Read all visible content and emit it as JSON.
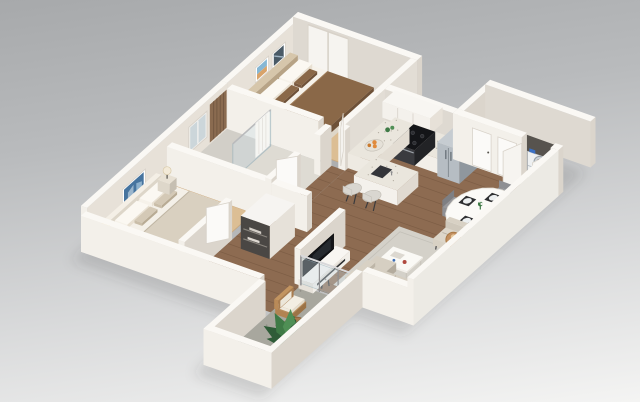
{
  "image": {
    "type": "3d-isometric-floor-plan-render",
    "subject": "Two-bedroom two-bath apartment 3D floor plan",
    "background": {
      "top": "#a7a9ab",
      "bottom": "#f4f4f3"
    }
  },
  "palette": {
    "wallLight": "#f3f0ea",
    "wallShade": "#dbd5cc",
    "wallTop": "#faf8f4",
    "wallInner": "#e7e1d8",
    "wallOuterBright": "#eceae4",
    "woodFloor": "#8d6b51",
    "plankLine": "rgba(70,45,28,0.22)",
    "carpet": "#dcbe94",
    "carpetEdge": "#c9a87e",
    "tile": "#dedbd3",
    "tileShower": "#d2cfc8",
    "concrete": "#a8a79e",
    "rug": "#d4d1c9",
    "rugLine": "#c3c0b8",
    "glass": "rgba(205,222,228,0.38)",
    "glassEdge": "rgba(150,175,185,0.6)",
    "tvBlack": "#141519",
    "steel": "#b6bdc3",
    "steelDark": "#8f979e",
    "steelTop": "#c6ccd1",
    "granite": "#eae6dd",
    "speckle": "#b4aea2",
    "stoveTop": "#141518",
    "stoveFront": "#3a3b3f",
    "stoveSide": "#222326",
    "bedBrown": "#8a6848",
    "bedBrownDark": "#6e5138",
    "pillowBrown": "#7a5a40",
    "cream": "#f2eee6",
    "creamShade": "#ded6c8",
    "headboardTan": "#c9b69c",
    "bed2Blanket": "#d9d0c0",
    "sofaTop": "#d6cfc2",
    "sofaFront": "#cdc5b7",
    "sofaSide": "#b3ab9d",
    "woodChair": "#a87c4f",
    "woodChairLight": "#b98a58",
    "rattan": "#c28f5f",
    "rattanEdge": "#a87844",
    "plantDark": "#2f5c38",
    "plant": "#3f7a46",
    "plantLight": "#4f8f55",
    "artBlue": "#46749f",
    "artSky": "#86b7d4",
    "artSand": "#d8a36a",
    "artDark": "#4a5a66",
    "orange": "#e08a3c",
    "lampShade": "#f3ead8",
    "chairGray": "#8e8f93",
    "chairGrayDark": "#7e7f83",
    "chairGrayTop": "#97989c",
    "mat": "#2e2f31",
    "plate": "#eceff0",
    "slatWood": "#8a6b50",
    "slatLine": "#6e543e",
    "doorWhite": "#fbfaf8",
    "doorEdge": "#d8d2c9",
    "darkRecess": "#57534e",
    "closetDark": "#4a4744",
    "shadow": "rgba(55,56,60,0.16)",
    "legDark": "#3b3b3d",
    "detergentBlue": "#3a6fc4",
    "bowlRed": "#b0493f",
    "bookBlue": "#3d6db5"
  },
  "scene": {
    "rooms": [
      {
        "name": "master-bedroom",
        "furniture": [
          "double-bed",
          "headboard",
          "nightstand",
          "table-lamp",
          "wall-art-frames",
          "sliding-closet-doors"
        ]
      },
      {
        "name": "master-bathroom",
        "furniture": [
          "glass-shower",
          "shower-curtain",
          "toilet",
          "vanity-sink",
          "wood-slat-accent-wall",
          "window"
        ]
      },
      {
        "name": "second-bedroom",
        "furniture": [
          "double-bed",
          "nightstands",
          "table-lamps",
          "blue-wall-art"
        ]
      },
      {
        "name": "hallway",
        "furniture": [
          "linen-closet"
        ]
      },
      {
        "name": "kitchen",
        "furniture": [
          "upper-cabinets",
          "counter",
          "stove",
          "refrigerator",
          "island",
          "bar-stools",
          "fruit-bowl"
        ]
      },
      {
        "name": "entry",
        "furniture": [
          "interior-doors",
          "stacked-washer-dryer",
          "bifold-doors"
        ]
      },
      {
        "name": "dining-area",
        "furniture": [
          "round-table",
          "chairs",
          "placemats",
          "flower-vase",
          "potted-plant"
        ]
      },
      {
        "name": "living-room",
        "furniture": [
          "sofa",
          "armchair",
          "coffee-table",
          "tv-console",
          "tv",
          "rug",
          "floor-lamps",
          "side-table"
        ]
      },
      {
        "name": "balcony",
        "furniture": [
          "wood-armchair",
          "side-table",
          "monstera-plant",
          "glass-railing"
        ]
      }
    ]
  }
}
